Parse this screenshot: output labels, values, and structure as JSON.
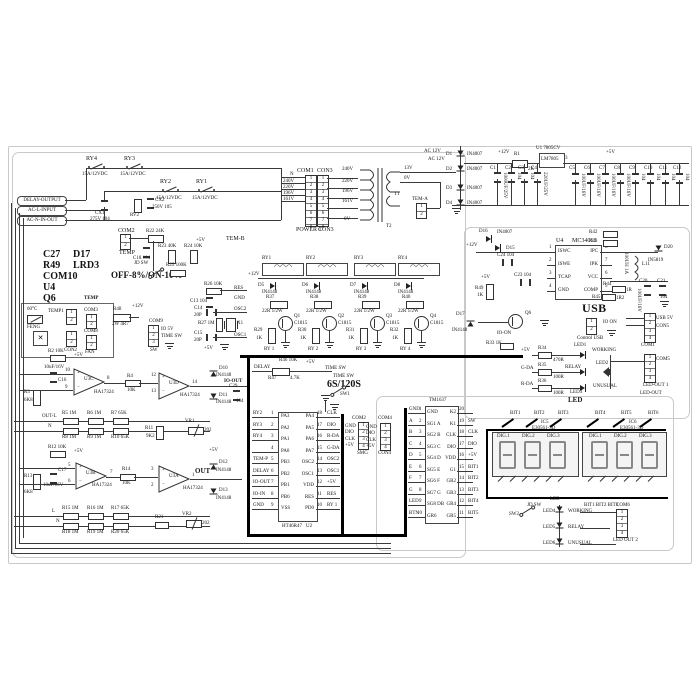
{
  "pins": [
    "1",
    "2",
    "3",
    "4",
    "5",
    "6",
    "7",
    "8"
  ],
  "sym": {
    "plus": "+",
    "minus": "−",
    "coil": "◠◠◠",
    "fan": "✕"
  },
  "term": {
    "pills": [
      "DELAY-OUTPUT",
      "AC-L-INPUT",
      "AC-N-IN-OUT"
    ]
  },
  "acin": {
    "r4": "RY4",
    "r3": "RY3",
    "r2": "RY2",
    "r1": "RY1",
    "amp": "15A/12VDC",
    "cx1": "CX1",
    "cx1v": "275V 104",
    "rv2": "RV2",
    "cx2": "CX2",
    "cx2v": "250V 105",
    "temb": "TEM-B"
  },
  "refs": {
    "a": "C27",
    "b": "D17",
    "c": "R49",
    "d": "LRD3",
    "e": "COM10",
    "f": "U4",
    "g": "Q6",
    "mode": "OFF-8%/ON-10%"
  },
  "tcol": {
    "com": "COM2",
    "temp": "TEMP",
    "jd": "JD SW",
    "r22": "R22 24K",
    "c18": "C18 104",
    "r23": "R23 40K",
    "r24": "R24 10K",
    "v5": "+5V",
    "r25": "R25 100K"
  },
  "pwr": {
    "com1": "COM1",
    "con3": "CON3",
    "pwr1": "POWER 1",
    "con3b": "CON3",
    "nets": [
      "N",
      "240V",
      "220V",
      "196V",
      "161V"
    ],
    "taps": [
      "240V",
      "220V",
      "196V",
      "161V",
      "0V"
    ],
    "s13": "13V",
    "s0": "0V",
    "t1": "T1",
    "t2": "T2",
    "tema": "TEM-A"
  },
  "rect": {
    "ac12": "AC 12V",
    "d": [
      "D1",
      "D2",
      "D3",
      "D4"
    ],
    "dv": "IN4007",
    "v12": "+12V",
    "r1": "R1",
    "r1v": "2K",
    "u1": "U1 7805CV",
    "chip": "LM7805",
    "p3": "3",
    "v5": "+5V",
    "cn": [
      "C1",
      "C2",
      "C3",
      "C4",
      "C5",
      "C6",
      "C7",
      "C8",
      "C9",
      "C10",
      "C11",
      "C12"
    ],
    "cv": [
      "1000UF/25V",
      "104",
      "104",
      "220UF/25V",
      "100UF/16V",
      "100UF/16V",
      "100UF/16V",
      "100UF/16V",
      "104",
      "104",
      "104",
      "104"
    ]
  },
  "buck": {
    "v12": "+12V",
    "d16": "D16",
    "d16v": "IN4007",
    "d15": "D15",
    "c24": "C24 104",
    "c23": "C23 104",
    "u4": "U4",
    "mc": "MC34063",
    "ln": [
      "ISWC",
      "ISWE",
      "TCAP",
      "GND"
    ],
    "rn": [
      "IPC",
      "IPK",
      "VCC",
      "COMP"
    ],
    "rp": [
      "8",
      "7",
      "6",
      "5"
    ],
    "r42": "R42",
    "r43": "R43",
    "l11": "L11",
    "l11v": "100UH 1A",
    "d20": "D20",
    "d20v": "IN5819",
    "r44": "R44",
    "r44v": "1R",
    "r45": "R45",
    "r45v": "1R2",
    "c20": "C20",
    "c20v": "100UF/16V",
    "c21": "C21",
    "c21v": "104",
    "r49": "R49",
    "r49v": "1K",
    "v5": "+5V",
    "d17": "D17",
    "d17v": "IN4148",
    "q6": "Q6",
    "io": "IO-ON",
    "r33": "R33 1K"
  },
  "usb": {
    "t": "USB",
    "ctl": "Control USB",
    "io": "IO ON",
    "com1": "COM1",
    "u5": "USB 5V",
    "con5": "CON5"
  },
  "ledr": {
    "v5": "+5V",
    "gd": "G-DA",
    "rd": "R-DA",
    "r34": "R34",
    "r34v": "470R",
    "r35": "R35",
    "r36": "R36",
    "r100": "100R",
    "l1": "LED1",
    "l2": "LED2",
    "l3": "LED3",
    "w": "WORKING",
    "re": "RELAY",
    "un": "UNUSUAL",
    "cap": "LED",
    "com5": "COM5",
    "lo1": "LED-OUT 1",
    "lo": "LED-OUT"
  },
  "coils": {
    "n": [
      "RY1",
      "RY2",
      "RY3",
      "RY4"
    ],
    "v12": "+12V",
    "d": [
      "D5",
      "D6",
      "D7",
      "D8"
    ],
    "dv": "IN4148",
    "r": [
      "R37",
      "R38",
      "R39",
      "R40"
    ],
    "rv": "22R 1/2W",
    "q": [
      "Q1",
      "Q2",
      "Q3",
      "Q4"
    ],
    "qv": "C1815",
    "rb": [
      "R29",
      "R30",
      "R31",
      "R32"
    ],
    "rbv": "1K",
    "net": [
      "RY 1",
      "RY 2",
      "RY 3",
      "RY 4"
    ]
  },
  "dly": {
    "n": "DELAY",
    "r47": "R47",
    "r47v": "4.7K",
    "r46": "R46 10K",
    "v5": "+5V",
    "tsw": "TIME SW",
    "big": "6S/120S",
    "sw": "SW1"
  },
  "tfan": {
    "deg": "60°C",
    "t1": "TEMP1",
    "feng": "FENG",
    "con2": "CON2",
    "temp": "TEMP",
    "com3": "COM3",
    "com8": "COM8",
    "fan": "FAN",
    "r48": "R48",
    "r48v": "2W 4R7",
    "v12": "+12V",
    "com9": "COM9",
    "sw": "SW",
    "io5": "IO 5V",
    "tsw": "TIME SW"
  },
  "a1": {
    "r2": "R2 10K",
    "v5": "+5V",
    "c16": "C16",
    "c16v": "10uF/16V",
    "r3": "R3",
    "r3v": "6K8",
    "u": "U3C",
    "h": "HA17324",
    "pa": "10",
    "pb": "9",
    "po": "8",
    "r4": "R4",
    "r4v": "10K",
    "u2": "U3D",
    "pa2": "12",
    "pb2": "13",
    "po2": "14",
    "d10": "D10",
    "d11": "D11",
    "dv": "IN4148",
    "c29": "C29",
    "c29v": "104",
    "out": "IO-OUT",
    "outl": "OUT-L",
    "n": "N",
    "r5": "R5 1M",
    "r6": "R6 1M",
    "r7": "R7 65K",
    "r8": "R8 1M",
    "r9": "R9 1M",
    "r10": "R10 65K",
    "r11": "R11",
    "r11v": "9K2",
    "vr": "VR1",
    "vrv": "202"
  },
  "a2": {
    "r12": "R12 10K",
    "v5": "+5V",
    "c17": "C17",
    "c17v": "10uF/16V",
    "r13": "R13",
    "r13v": "6K8",
    "u": "U3B",
    "h": "HA17324",
    "pa": "5",
    "pb": "6",
    "po": "7",
    "r14": "R14",
    "r14v": "10K",
    "u2": "U3A",
    "pa2": "3",
    "pb2": "2",
    "po2": "1",
    "out": "OUT",
    "d12": "D12",
    "d13": "D13",
    "dv": "IN4148",
    "l": "L",
    "n": "N",
    "r15": "R15 1M",
    "r16": "R16 1M",
    "r17": "R17 65K",
    "r18": "R18 1M",
    "r19": "R19 1M",
    "r20": "R20 65K",
    "r21": "R21",
    "vr": "VR2",
    "vrv": "202"
  },
  "mcu": {
    "chip": "HT46R47",
    "u": "U2",
    "l": [
      [
        "1",
        "PA3",
        "RY2"
      ],
      [
        "2",
        "PA2",
        "RY3"
      ],
      [
        "3",
        "PA1",
        "RY4"
      ],
      [
        "4",
        "PA0",
        ""
      ],
      [
        "5",
        "PB3",
        "TEM-P"
      ],
      [
        "6",
        "PB2",
        "DELAY"
      ],
      [
        "7",
        "PB1",
        "IO-OUT"
      ],
      [
        "8",
        "PB0",
        "IO-IN"
      ],
      [
        "9",
        "VSS",
        "GND"
      ]
    ],
    "r": [
      [
        "18",
        "PA4",
        "CLK"
      ],
      [
        "17",
        "PA5",
        "DIO"
      ],
      [
        "16",
        "PA6",
        "R-DA"
      ],
      [
        "15",
        "PA7",
        "G-DA"
      ],
      [
        "14",
        "OSC2",
        "OSC2"
      ],
      [
        "13",
        "OSC1",
        "OSC1"
      ],
      [
        "12",
        "VDD",
        "+5V"
      ],
      [
        "11",
        "RES",
        "RES"
      ],
      [
        "10",
        "PD0",
        "RY 1"
      ]
    ],
    "r26": "R26 10K",
    "c13": "C13 104",
    "c14": "C14",
    "p20": "20P",
    "r27": "R27 1M",
    "x1": "X1",
    "c15": "C15",
    "v5": "+5V",
    "com": "COM2",
    "smg": "SMG",
    "cn": [
      "GND",
      "DIO",
      "CLK",
      "+5V"
    ]
  },
  "tm": {
    "chip": "TM1637",
    "l": [
      [
        "1",
        "GND",
        "GND"
      ],
      [
        "2",
        "SG1 A",
        "A"
      ],
      [
        "3",
        "SG2 B",
        "B"
      ],
      [
        "4",
        "SG3 C",
        "C"
      ],
      [
        "5",
        "SG4 D",
        "D"
      ],
      [
        "6",
        "SG5 E",
        "E"
      ],
      [
        "7",
        "SG6 F",
        "F"
      ],
      [
        "8",
        "SG7 G",
        "G"
      ],
      [
        "9",
        "SG8 DB",
        "LED"
      ],
      [
        "10",
        "GR6",
        "BTN"
      ]
    ],
    "r": [
      [
        "20",
        "K2",
        ""
      ],
      [
        "19",
        "K1",
        "SW"
      ],
      [
        "18",
        "CLK",
        "CLK"
      ],
      [
        "17",
        "DIO",
        "DIO"
      ],
      [
        "16",
        "VDD",
        "+5V"
      ],
      [
        "15",
        "G1",
        "BIT1"
      ],
      [
        "14",
        "GR2",
        "BIT2"
      ],
      [
        "13",
        "GR3",
        "BIT3"
      ],
      [
        "12",
        "GR4",
        "BIT4"
      ],
      [
        "11",
        "GR5",
        "BIT5"
      ]
    ],
    "com4": "COM4",
    "con4": "CON4",
    "cn": [
      "GND",
      "DIO",
      "CLK",
      "+5V"
    ]
  },
  "disp": {
    "bits": [
      "BIT1",
      "BIT2",
      "BIT3",
      "BIT4",
      "BIT5",
      "BIT6"
    ],
    "ic5": "IC5",
    "ic6": "IC6",
    "part": "E30561-3D",
    "dg": [
      "DIG.1",
      "DIG.2",
      "DIG.3"
    ]
  },
  "bot": {
    "jd": "JD SW",
    "sw": "SW2",
    "cap": "LED",
    "l4": "LED4",
    "l5": "LED5",
    "l6": "LED6",
    "w": "WORKING",
    "re": "RELAY",
    "un": "UNUSUAL",
    "bits": "BIT1 BIT2 BIT3",
    "com6": "COM6",
    "lo2": "LED OUT 2"
  }
}
